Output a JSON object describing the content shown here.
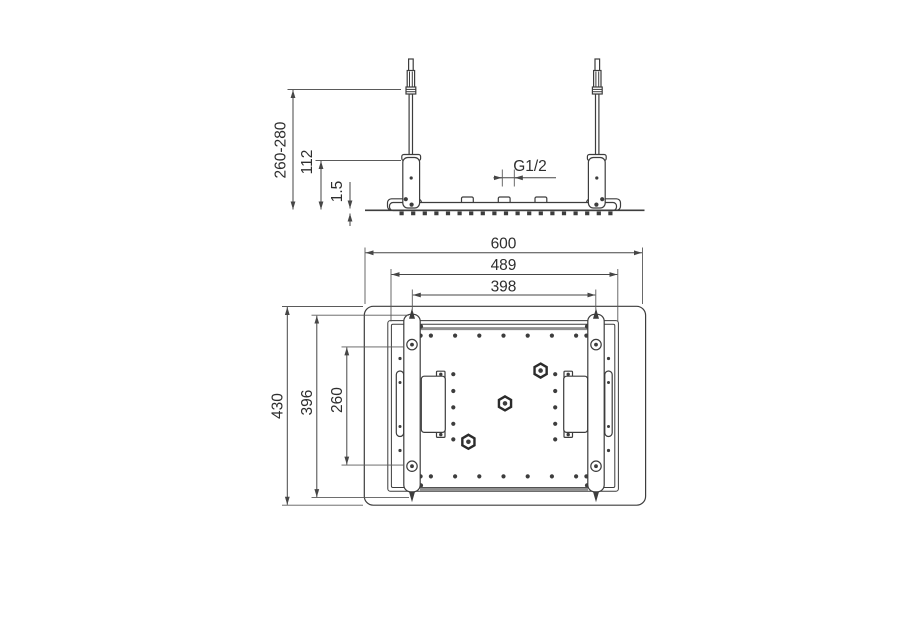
{
  "title": "ceiling-shower-head-mounting-technical-drawing",
  "colors": {
    "background": "#ffffff",
    "line": "#3d3d3d",
    "dimension_line": "#464646",
    "text": "#2e2e2e",
    "shade": "#8f8f8f"
  },
  "views": {
    "side_elevation": {
      "name": "side elevation view",
      "dims": {
        "adjustable_height": "260-280",
        "bracket_height": "112",
        "panel_thickness": "1.5",
        "thread": "G1/2"
      }
    },
    "plan": {
      "name": "bottom plan view",
      "dims": {
        "overall_width": "600",
        "plate_width": "489",
        "rod_spacing": "398",
        "overall_depth": "430",
        "rail_length": "396",
        "hole_spacing": "260"
      }
    }
  }
}
